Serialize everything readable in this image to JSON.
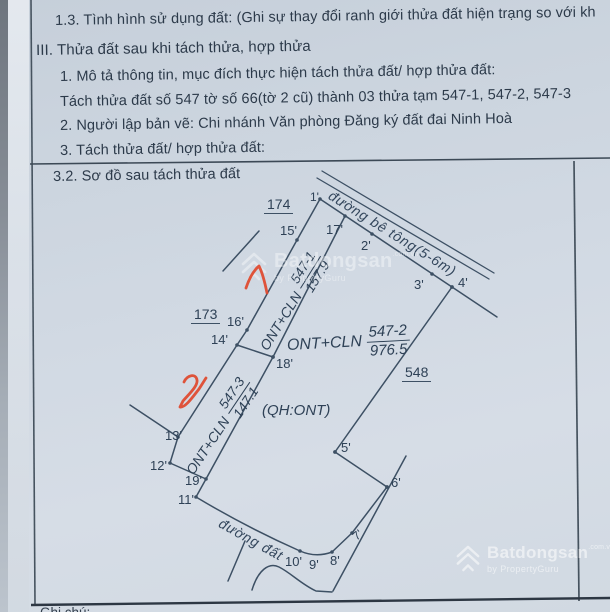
{
  "page": {
    "paper_color": "#ccd5df",
    "ink_color": "#3d5064",
    "text_color": "#2c3a4a",
    "red_mark_color": "#e0482c",
    "watermark_color": "#ffffff"
  },
  "document": {
    "lines": [
      "1.3. Tình hình sử dụng đất: (Ghi sự thay đổi ranh giới thửa đất hiện trạng so với kh",
      "III. Thửa đất sau khi tách thửa, hợp thửa",
      "1. Mô tả thông tin, mục đích thực hiện tách thửa đất/ hợp thửa đất:",
      "Tách thửa đất số 547 tờ số 66(tờ 2 cũ)  thành 03 thửa tạm 547-1, 547-2, 547-3",
      "2. Người lập bản vẽ:  Chi nhánh Văn phòng Đăng ký đất đai Ninh Hoà",
      "3. Tách thửa đất/ hợp thửa đất:"
    ],
    "section_title": "3.2. Sơ đồ sau tách thửa đất",
    "footer_partial": "Ghi chú:"
  },
  "diagram": {
    "roads": {
      "concrete": "đường bê tông(5-6m)",
      "dirt": "đường đất"
    },
    "neighbors": {
      "upper_left": "174",
      "lower_left": "173",
      "east": "548"
    },
    "parcels": [
      {
        "id": "547-1",
        "land_use": "ONT+CLN",
        "area": "157.9"
      },
      {
        "id": "547-2",
        "land_use": "ONT+CLN",
        "area": "976.5",
        "planning_note": "(QH:ONT)"
      },
      {
        "id": "547-3",
        "land_use": "ONT+CLN",
        "area": "147.1"
      }
    ],
    "points": {
      "p1": "1'",
      "p2": "2'",
      "p3": "3'",
      "p4": "4'",
      "p5": "5'",
      "p6": "6'",
      "p7": "7'",
      "p8": "8'",
      "p9": "9'",
      "p10": "10'",
      "p11": "11'",
      "p12": "12'",
      "p13": "13'",
      "p14": "14'",
      "p15": "15'",
      "p16": "16'",
      "p17": "17'",
      "p18": "18'",
      "p19": "19'"
    },
    "handwritten_marks": [
      {
        "label": "1",
        "near_parcel": "547-1"
      },
      {
        "label": "2",
        "near_parcel": "547-3"
      }
    ]
  },
  "watermark": {
    "brand": "Batdongsan",
    "domain_suffix": ".com.vn",
    "byline": "by PropertyGuru"
  }
}
